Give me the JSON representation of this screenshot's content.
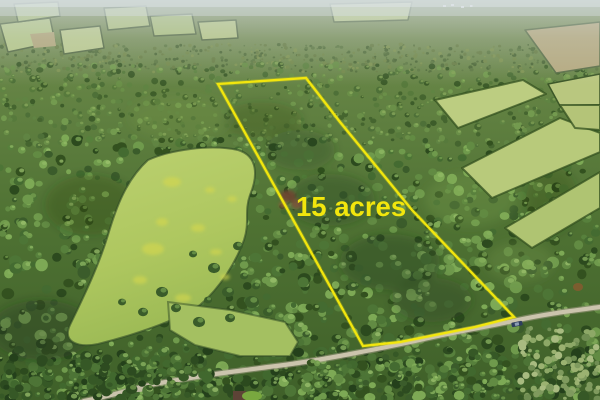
{
  "photo": {
    "kind": "aerial-photo-listing",
    "acreage_label": "15 acres",
    "accent_yellow": "#f2e60d",
    "boundary_points": "218,84 306,78 340,122 412,210 514,317 475,327 440,334 400,342 363,346",
    "scene": {
      "forest_dark": "#33511f",
      "forest_light": "#7da955",
      "meadow_green": "#b3cb68",
      "field_green": "#bccd81",
      "field_tan": "#b5aa80",
      "road_color": "#cbc4ad",
      "vehicle_color": "#2e3e5e",
      "haze_color": "#d4dde2",
      "dead_tree_color": "#6e4530"
    }
  }
}
